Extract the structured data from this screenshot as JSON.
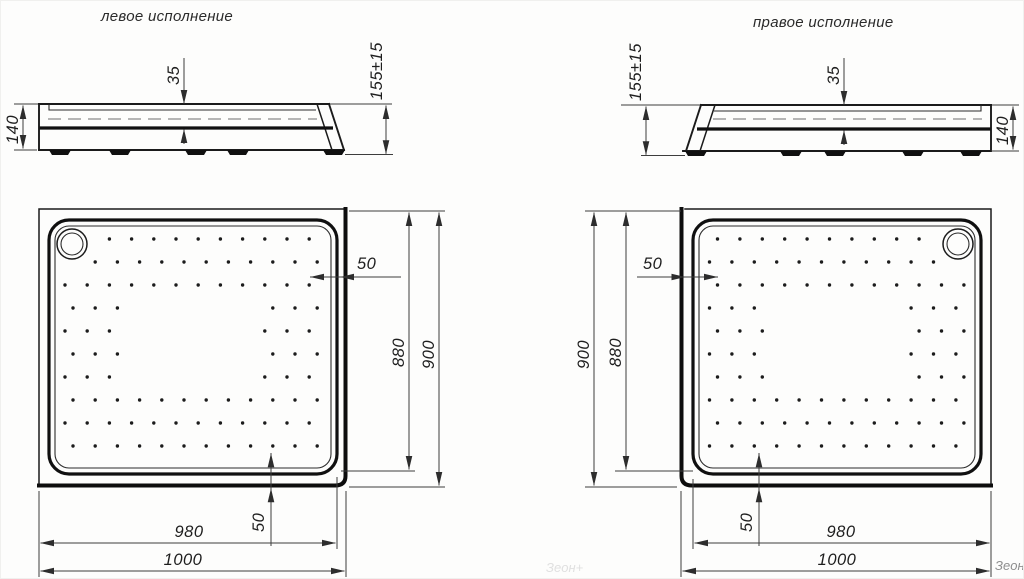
{
  "titles": {
    "left": "левое исполнение",
    "right": "правое исполнение"
  },
  "dimensions": {
    "body_height": "140",
    "basin_depth": "35",
    "total_height": "155±15",
    "pattern_offset": "50",
    "rim_size_y": "880",
    "overall_size_y": "900",
    "rim_size_x": "980",
    "overall_size_x": "1000"
  },
  "watermark": {
    "text": "Зеон+"
  }
}
